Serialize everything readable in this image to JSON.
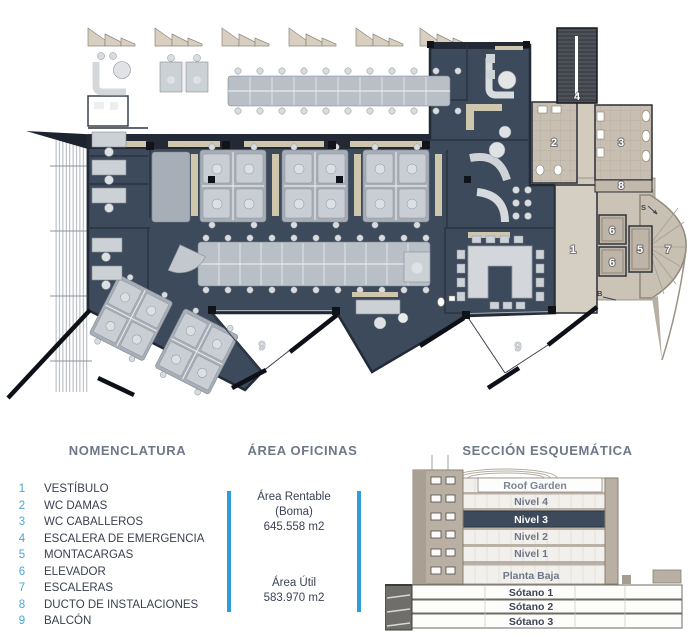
{
  "plan": {
    "area_label": "ÁREA OFICINAS",
    "rooms": [
      {
        "id": "vestibulo",
        "label": "1"
      },
      {
        "id": "wc-damas",
        "label": "2"
      },
      {
        "id": "wc-caballeros",
        "label": "3"
      },
      {
        "id": "escalera-emergencia",
        "label": "4"
      },
      {
        "id": "montacargas",
        "label": "5"
      },
      {
        "id": "elevador-a",
        "label": "6"
      },
      {
        "id": "elevador-b",
        "label": "6"
      },
      {
        "id": "escaleras",
        "label": "7"
      },
      {
        "id": "ducto-instalaciones",
        "label": "8"
      }
    ],
    "balconies": [
      {
        "label": "9"
      },
      {
        "label": "9"
      }
    ],
    "annotations": {
      "stair_up": "S",
      "stair_down": "B"
    }
  },
  "legend": {
    "title": "NOMENCLATURA",
    "items": [
      {
        "num": "1",
        "label": "VESTÍBULO"
      },
      {
        "num": "2",
        "label": "WC DAMAS"
      },
      {
        "num": "3",
        "label": "WC CABALLEROS"
      },
      {
        "num": "4",
        "label": "ESCALERA DE EMERGENCIA"
      },
      {
        "num": "5",
        "label": "MONTACARGAS"
      },
      {
        "num": "6",
        "label": "ELEVADOR"
      },
      {
        "num": "7",
        "label": "ESCALERAS"
      },
      {
        "num": "8",
        "label": "DUCTO DE INSTALACIONES"
      },
      {
        "num": "9",
        "label": "BALCÓN"
      }
    ]
  },
  "area_panel": {
    "title": "ÁREA OFICINAS",
    "rentable_label": "Área Rentable",
    "rentable_sub": "(Boma)",
    "rentable_value": "645.558 m2",
    "util_label": "Área Útil",
    "util_value": "583.970 m2"
  },
  "section": {
    "title": "SECCIÓN ESQUEMÁTICA",
    "levels": [
      {
        "name": "Roof Garden",
        "highlight": false
      },
      {
        "name": "Nivel 4",
        "highlight": false
      },
      {
        "name": "Nivel 3",
        "highlight": true
      },
      {
        "name": "Nivel 2",
        "highlight": false
      },
      {
        "name": "Nivel 1",
        "highlight": false
      },
      {
        "name": "Planta Baja",
        "highlight": false
      }
    ],
    "basements": [
      {
        "name": "Sótano 1"
      },
      {
        "name": "Sótano 2"
      },
      {
        "name": "Sótano 3"
      }
    ]
  },
  "colors": {
    "plan_navy": "#3d4a5b",
    "highlight_navy": "#3d4a5c",
    "accent_blue": "#2d9ed8",
    "legend_number_blue": "#4ba4d6",
    "core_tan": "#cdc5b8",
    "awning_tan": "#d8cfc0",
    "text_navy": "#3a4254",
    "heading_gray": "#6e7888"
  }
}
